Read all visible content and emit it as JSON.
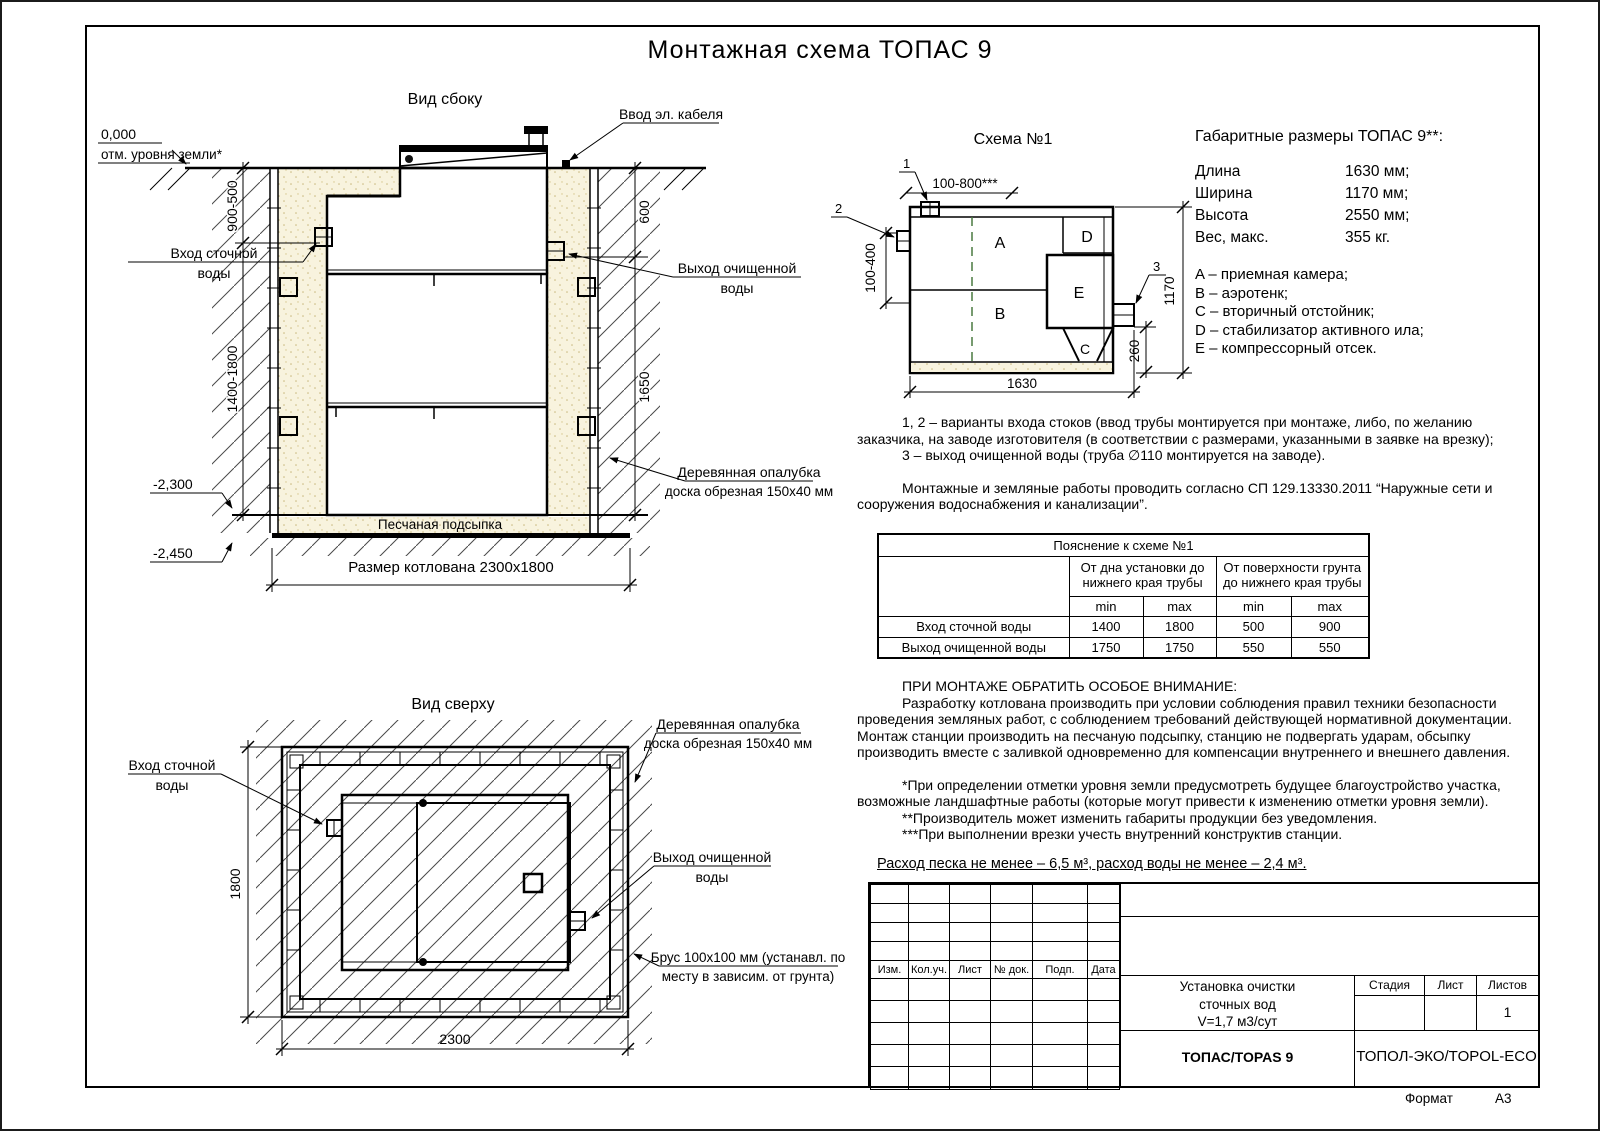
{
  "sheet": {
    "title": "Монтажная схема ТОПАС 9",
    "format_label": "Формат",
    "format_value": "А3"
  },
  "colors": {
    "green": "#3a5c28",
    "sand": "#f8f3de",
    "line": "#000000"
  },
  "side_view": {
    "title": "Вид сбоку",
    "zero_mark": "0,000",
    "ground_level_label": "отм. уровня земли*",
    "cable_label": "Ввод эл. кабеля",
    "inlet_line1": "Вход сточной",
    "inlet_line2": "воды",
    "outlet_line1": "Выход очищенной",
    "outlet_line2": "воды",
    "formwork_line1": "Деревянная опалубка",
    "formwork_line2": "доска обрезная 150х40 мм",
    "sand_label": "Песчаная подсыпка",
    "pit_label": "Размер котлована 2300х1800",
    "dim_left_top": "900-500",
    "dim_left_bottom": "1400-1800",
    "dim_right_top": "600",
    "dim_right_bottom": "1650",
    "level_bottom": "-2,300",
    "level_bed": "-2,450"
  },
  "top_view": {
    "title": "Вид сверху",
    "inlet_line1": "Вход сточной",
    "inlet_line2": "воды",
    "outlet_line1": "Выход очищенной",
    "outlet_line2": "воды",
    "formwork_line1": "Деревянная опалубка",
    "formwork_line2": "доска обрезная 150х40 мм",
    "beam_line1": "Брус 100х100 мм (устанавл. по",
    "beam_line2": "месту в зависим. от грунта)",
    "dim_width": "1800",
    "dim_length": "2300"
  },
  "schema": {
    "title": "Схема №1",
    "marker1": "1",
    "marker2": "2",
    "marker3": "3",
    "chamber_a": "A",
    "chamber_b": "B",
    "chamber_c": "C",
    "chamber_d": "D",
    "chamber_e": "E",
    "dim_top": "100-800***",
    "dim_left": "100-400",
    "dim_bottom": "1630",
    "dim_right": "1170",
    "dim_outlet": "260"
  },
  "specs": {
    "heading": "Габаритные размеры ТОПАС 9**:",
    "rows": [
      {
        "name": "Длина",
        "value": "1630 мм;"
      },
      {
        "name": "Ширина",
        "value": "1170 мм;"
      },
      {
        "name": "Высота",
        "value": "2550 мм;"
      },
      {
        "name": "Вес, макс.",
        "value": "355 кг."
      }
    ],
    "legend": [
      "A – приемная камера;",
      "B – аэротенк;",
      "C – вторичный отстойник;",
      "D – стабилизатор активного ила;",
      "E – компрессорный отсек."
    ]
  },
  "notes": {
    "variants_1": "1, 2 – варианты входа  стоков (ввод трубы монтируется при монтаже, либо, по желанию заказчика, на заводе изготовителя (в соответствии с размерами, указанными в заявке на врезку);",
    "variants_2": "3 – выход очищенной воды (труба ∅110 монтируется на заводе).",
    "sp_note": "Монтажные и земляные работы проводить согласно СП 129.13330.2011 “Наружные сети и сооружения водоснабжения и канализации”.",
    "attention_heading": "ПРИ МОНТАЖЕ ОБРАТИТЬ ОСОБОЕ ВНИМАНИЕ:",
    "attention_body": "Разработку котлована производить при условии соблюдения правил техники безопасности проведения земляных работ, с соблюдением требований действующей нормативной документации. Монтаж станции производить на песчаную подсыпку, станцию не подвергать ударам, обсыпку производить вместе с заливкой одновременно для компенсации внутреннего и внешнего давления.",
    "footnote_1": "*При определении отметки уровня земли предусмотреть будущее благоустройство участка, возможные ландшафтные работы (которые могут привести к изменению отметки уровня земли).",
    "footnote_2": "**Производитель может изменить габариты продукции без уведомления.",
    "footnote_3": "***При выполнении врезки учесть внутренний конструктив станции.",
    "consumption": "Расход песка не менее – 6,5 м³, расход воды не менее – 2,4 м³."
  },
  "table": {
    "title": "Пояснение к схеме №1",
    "group1": "От дна установки до нижнего края трубы",
    "group2": "От поверхности грунта до нижнего края трубы",
    "min": "min",
    "max": "max",
    "rows": [
      {
        "name": "Вход сточной воды",
        "v": [
          "1400",
          "1800",
          "500",
          "900"
        ]
      },
      {
        "name": "Выход очищенной воды",
        "v": [
          "1750",
          "1750",
          "550",
          "550"
        ]
      }
    ]
  },
  "stamp": {
    "cols": [
      "Изм.",
      "Кол.уч.",
      "Лист",
      "№ док.",
      "Подп.",
      "Дата"
    ],
    "product_1": "Установка очистки",
    "product_2": "сточных вод",
    "product_3": "V=1,7 м3/сут",
    "model": "ТОПАС/TOPAS 9",
    "company": "ТОПОЛ-ЭКО/TOPOL-ECO",
    "stage_label": "Стадия",
    "sheet_label": "Лист",
    "sheets_label": "Листов",
    "sheets_value": "1"
  }
}
